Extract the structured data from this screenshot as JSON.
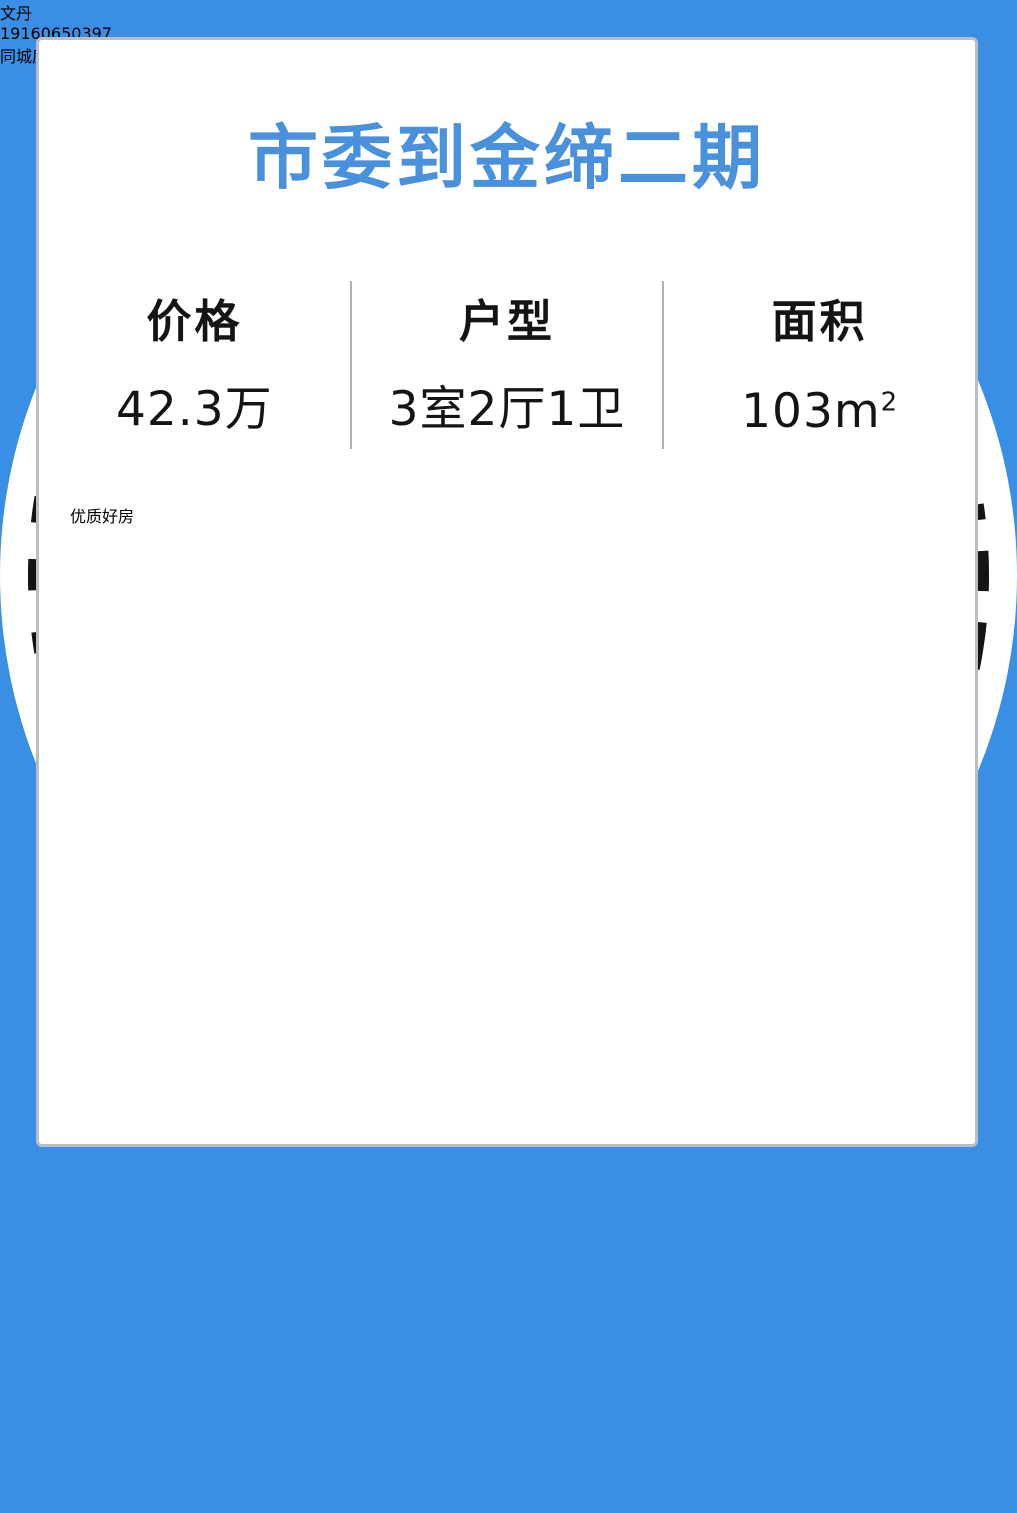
{
  "theme": {
    "bg_blue": "#3a8ee3",
    "title_blue": "#4a91dd",
    "badge_blue": "#2f96ea",
    "text_dark": "#141414",
    "wechat_green": "#21b24a"
  },
  "title": "市委到金缔二期",
  "stats": [
    {
      "label": "价格",
      "value": "42.3万"
    },
    {
      "label": "户型",
      "value": "3室2厅1卫"
    },
    {
      "label": "面积",
      "value": "103m",
      "sup": "2"
    }
  ],
  "badge": "优质好房",
  "photos": {
    "main": "living-room",
    "top_right": "bedroom",
    "bottom_right": "study-room"
  },
  "agent": {
    "name": "文丹",
    "phone": "19160650397",
    "company": "同城房产 (六分店)"
  },
  "qr": {
    "logo": "wechat-icon",
    "logo_letter": "S"
  }
}
